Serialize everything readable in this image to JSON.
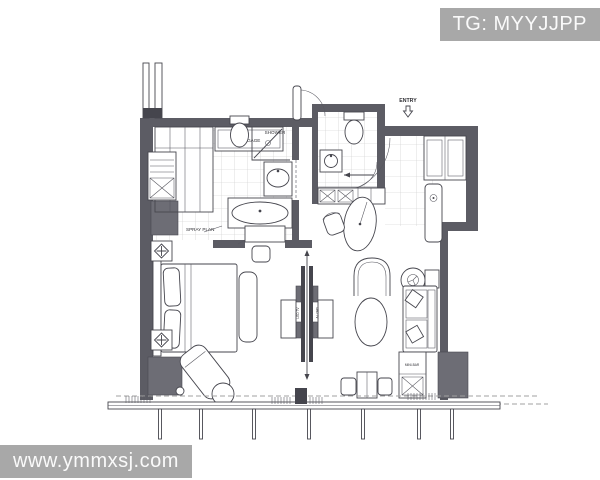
{
  "watermarks": {
    "top_right": "TG: MYYJJPP",
    "bottom_left": "www.ymmxsj.com"
  },
  "colors": {
    "badge_bg": "#a8a8a8",
    "badge_text": "#fafafa",
    "wall": "#5c5c64",
    "column": "#6d6d75",
    "line": "#46464e",
    "background": "#ffffff"
  },
  "floorplan": {
    "labels": {
      "entry": "ENTRY",
      "luggage": "LUGGAGE",
      "shower": "SHOWER",
      "spray_plan": "SPRAY PLAN",
      "dressing": "DRESSING",
      "minibar": "MINI-BAR",
      "tv_left": "LED TV",
      "tv_right": "LED TV"
    }
  }
}
